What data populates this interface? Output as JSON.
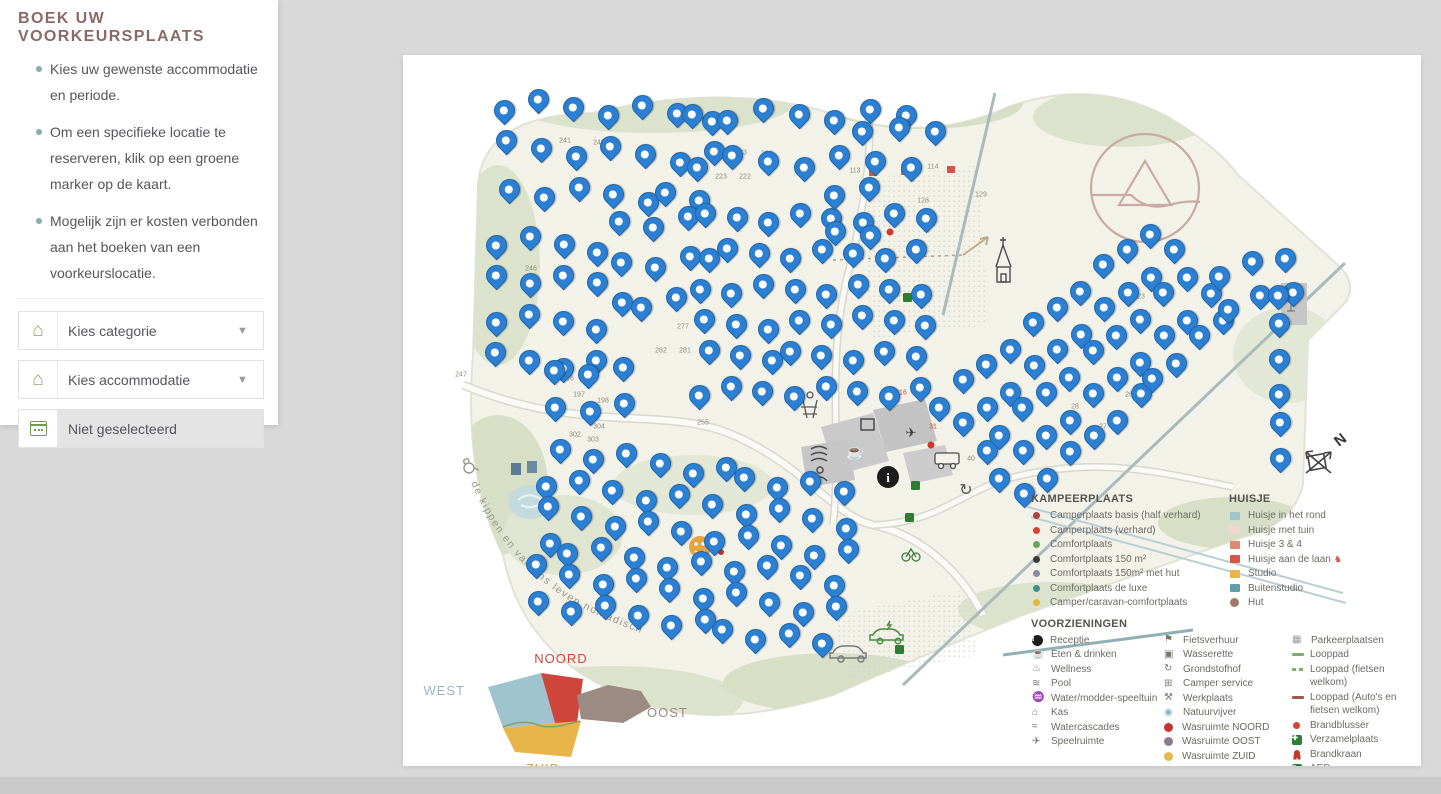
{
  "page": {
    "background": "#d9d9d9"
  },
  "sidebar": {
    "title": "BOEK UW VOORKEURSPLAATS",
    "instructions": [
      "Kies uw gewenste accommodatie en periode.",
      "Om een specifieke locatie te reserveren, klik op een groene marker op de kaart.",
      "Mogelijk zijn er kosten verbonden aan het boeken van een voorkeurslocatie."
    ],
    "category_dropdown": {
      "label": "Kies categorie"
    },
    "accommodation_dropdown": {
      "label": "Kies accommodatie"
    },
    "date_field": {
      "label": "Niet geselecteerd"
    }
  },
  "map": {
    "pin_color": "#2c80d3",
    "pin_border": "#1f65a8",
    "curved_text": "de kippen en varkens leven nomadisch",
    "compass_label": "N",
    "region_overview": {
      "north": "NOORD",
      "west": "WEST",
      "east": "OOST",
      "south": "ZUID",
      "north_color": "#d0453a",
      "west_color": "#9fc3cf",
      "east_color": "#9c8b82",
      "south_color": "#e8b54a",
      "north_label_color": "#d0453a",
      "west_label_color": "#9db4bd",
      "east_label_color": "#9c8b82",
      "south_label_color": "#e2992f"
    },
    "pin_clusters": [
      {
        "x": 105,
        "y": 62,
        "cols": 7,
        "rows": 3,
        "dx": 34,
        "dy": 42,
        "rot": 3,
        "jit": 9
      },
      {
        "x": 100,
        "y": 196,
        "cols": 4,
        "rows": 4,
        "dx": 33,
        "dy": 41,
        "rot": 4,
        "jit": 8
      },
      {
        "x": 212,
        "y": 182,
        "cols": 3,
        "rows": 3,
        "dx": 34,
        "dy": 40,
        "rot": 0,
        "jit": 8
      },
      {
        "x": 296,
        "y": 74,
        "cols": 7,
        "rows": 2,
        "dx": 35,
        "dy": 46,
        "rot": 0,
        "jit": 9
      },
      {
        "x": 300,
        "y": 176,
        "cols": 8,
        "rows": 6,
        "dx": 31,
        "dy": 35,
        "rot": 0,
        "jit": 7
      },
      {
        "x": 150,
        "y": 330,
        "cols": 3,
        "rows": 2,
        "dx": 34,
        "dy": 36,
        "rot": 0,
        "jit": 6
      },
      {
        "x": 152,
        "y": 408,
        "cols": 10,
        "rows": 6,
        "dx": 33,
        "dy": 31,
        "rot": 8,
        "jit": 8
      },
      {
        "x": 540,
        "y": 362,
        "cols": 10,
        "rows": 5,
        "dx": 30,
        "dy": 30,
        "rot": -40,
        "jit": 6
      },
      {
        "x": 820,
        "y": 232,
        "cols": 3,
        "rows": 2,
        "dx": 33,
        "dy": 34,
        "rot": -12,
        "jit": 6
      },
      {
        "x": 876,
        "y": 252,
        "cols": 1,
        "rows": 6,
        "dx": 0,
        "dy": 33,
        "rot": 0,
        "jit": 4
      },
      {
        "x": 458,
        "y": 88,
        "cols": 3,
        "rows": 1,
        "dx": 36,
        "dy": 0,
        "rot": 2,
        "jit": 4
      },
      {
        "x": 428,
        "y": 150,
        "cols": 2,
        "rows": 2,
        "dx": 34,
        "dy": 40,
        "rot": 0,
        "jit": 6
      }
    ],
    "plot_numbers": [
      {
        "n": "241",
        "x": 162,
        "y": 86
      },
      {
        "n": "240",
        "x": 196,
        "y": 88
      },
      {
        "n": "233",
        "x": 338,
        "y": 98
      },
      {
        "n": "236",
        "x": 364,
        "y": 99
      },
      {
        "n": "223",
        "x": 318,
        "y": 122
      },
      {
        "n": "222",
        "x": 342,
        "y": 122
      },
      {
        "n": "246",
        "x": 128,
        "y": 214
      },
      {
        "n": "247",
        "x": 58,
        "y": 320
      },
      {
        "n": "277",
        "x": 280,
        "y": 272
      },
      {
        "n": "282",
        "x": 258,
        "y": 296
      },
      {
        "n": "281",
        "x": 282,
        "y": 296
      },
      {
        "n": "196",
        "x": 165,
        "y": 324
      },
      {
        "n": "197",
        "x": 176,
        "y": 340
      },
      {
        "n": "198",
        "x": 200,
        "y": 346
      },
      {
        "n": "199",
        "x": 226,
        "y": 350
      },
      {
        "n": "255",
        "x": 300,
        "y": 368
      },
      {
        "n": "302",
        "x": 172,
        "y": 380
      },
      {
        "n": "304",
        "x": 196,
        "y": 372
      },
      {
        "n": "303",
        "x": 190,
        "y": 385
      },
      {
        "n": "113",
        "x": 452,
        "y": 116
      },
      {
        "n": "114",
        "x": 530,
        "y": 112
      },
      {
        "n": "128",
        "x": 520,
        "y": 146
      },
      {
        "n": "129",
        "x": 578,
        "y": 140
      },
      {
        "n": "216",
        "x": 498,
        "y": 338,
        "c": "#d0453a"
      },
      {
        "n": "31",
        "x": 530,
        "y": 372,
        "c": "#d0453a"
      },
      {
        "n": "32",
        "x": 622,
        "y": 356
      },
      {
        "n": "27",
        "x": 700,
        "y": 372
      },
      {
        "n": "28",
        "x": 672,
        "y": 352
      },
      {
        "n": "26",
        "x": 726,
        "y": 340
      },
      {
        "n": "23",
        "x": 738,
        "y": 242
      },
      {
        "n": "22",
        "x": 752,
        "y": 222
      },
      {
        "n": "40",
        "x": 568,
        "y": 404
      }
    ],
    "legend": {
      "kampeerplaats": {
        "title": "KAMPEERPLAATS",
        "items": [
          {
            "label": "Camperplaats basis (half verhard)",
            "marker": "dot",
            "color": "#a8473a",
            "icon": "camperplaats-basis-dot"
          },
          {
            "label": "Camperplaats (verhard)",
            "marker": "dot",
            "color": "#d8422e",
            "icon": "camperplaats-verhard-dot"
          },
          {
            "label": "Comfortplaats",
            "marker": "dot",
            "color": "#6aa559",
            "icon": "comfortplaats-dot"
          },
          {
            "label": "Comfortplaats 150 m²",
            "marker": "dot",
            "color": "#3a3a3a",
            "icon": "comfortplaats-150-dot"
          },
          {
            "label": "Comfortplaats 150m² met hut",
            "marker": "dot",
            "color": "#8a8aa0",
            "icon": "comfortplaats-150-hut-dot"
          },
          {
            "label": "Comfortplaats de luxe",
            "marker": "dot",
            "color": "#3f8f8f",
            "icon": "comfortplaats-deluxe-dot"
          },
          {
            "label": "Camper/caravan-comfortplaats",
            "marker": "dot",
            "color": "#e0b83e",
            "icon": "camper-caravan-dot"
          }
        ]
      },
      "huisje": {
        "title": "HUISJE",
        "items": [
          {
            "label": "Huisje in het rond",
            "marker": "square",
            "color": "#9fc3cf",
            "icon": "huisje-rond-square"
          },
          {
            "label": "Huisje met tuin",
            "marker": "square",
            "color": "#f2d7cd",
            "icon": "huisje-tuin-square"
          },
          {
            "label": "Huisje 3 & 4",
            "marker": "square",
            "color": "#dd8a70",
            "icon": "huisje-3-4-square"
          },
          {
            "label": "Huisje aan de laan",
            "marker": "square",
            "color": "#d85446",
            "icon": "huisje-laan-square",
            "suffix": "♞",
            "suffix_color": "#d85446"
          },
          {
            "label": "Studio",
            "marker": "square",
            "color": "#e8b54a",
            "icon": "studio-square"
          },
          {
            "label": "Buitenstudio",
            "marker": "square",
            "color": "#5f9ea8",
            "icon": "buitenstudio-square"
          },
          {
            "label": "Hut",
            "marker": "bigdot",
            "color": "#9c7a64",
            "icon": "hut-dot"
          }
        ]
      },
      "voorzieningen": {
        "title": "VOORZIENINGEN",
        "col1": [
          {
            "label": "Receptie",
            "marker": "info",
            "icon": "receptie-info-icon"
          },
          {
            "label": "Eten & drinken",
            "marker": "glyph",
            "glyph": "☕",
            "icon": "eten-drinken-icon"
          },
          {
            "label": "Wellness",
            "marker": "glyph",
            "glyph": "♨",
            "icon": "wellness-icon"
          },
          {
            "label": "Pool",
            "marker": "glyph",
            "glyph": "≋",
            "icon": "pool-icon"
          },
          {
            "label": "Water/modder-speeltuin",
            "marker": "glyph",
            "glyph": "♒",
            "icon": "water-modder-speeltuin-icon"
          },
          {
            "label": "Kas",
            "marker": "glyph",
            "glyph": "⌂",
            "icon": "kas-icon"
          },
          {
            "label": "Watercascades",
            "marker": "glyph",
            "glyph": "≈",
            "icon": "watercascades-icon"
          },
          {
            "label": "Speelruimte",
            "marker": "glyph",
            "glyph": "✈",
            "icon": "speelruimte-icon"
          }
        ],
        "col2": [
          {
            "label": "Fietsverhuur",
            "marker": "glyph",
            "glyph": "⚑",
            "icon": "fietsverhuur-icon"
          },
          {
            "label": "Wasserette",
            "marker": "glyph",
            "glyph": "▣",
            "icon": "wasserette-icon"
          },
          {
            "label": "Grondstofhof",
            "marker": "glyph",
            "glyph": "↻",
            "icon": "grondstofhof-icon"
          },
          {
            "label": "Camper service",
            "marker": "glyph",
            "glyph": "⊞",
            "icon": "camper-service-icon"
          },
          {
            "label": "Werkplaats",
            "marker": "glyph",
            "glyph": "⚒",
            "icon": "werkplaats-icon"
          },
          {
            "label": "Natuurvijver",
            "marker": "glyph",
            "glyph": "◉",
            "color": "#7fb6c9",
            "icon": "natuurvijver-icon"
          },
          {
            "label": "Wasruimte NOORD",
            "marker": "bigdot",
            "color": "#c2362e",
            "icon": "wasruimte-noord-dot"
          },
          {
            "label": "Wasruimte OOST",
            "marker": "bigdot",
            "color": "#8f7b90",
            "icon": "wasruimte-oost-dot"
          },
          {
            "label": "Wasruimte ZUID",
            "marker": "bigdot",
            "color": "#e3b94d",
            "icon": "wasruimte-zuid-dot"
          }
        ],
        "col3": [
          {
            "label": "Parkeerplaatsen",
            "marker": "glyph",
            "glyph": "▦",
            "color": "#9a9a94",
            "icon": "parkeerplaatsen-icon"
          },
          {
            "label": "Looppad",
            "marker": "line",
            "color": "#7fae6a",
            "icon": "looppad-line"
          },
          {
            "label": "Looppad (fietsen welkom)",
            "marker": "dashes",
            "color": "#7fae6a",
            "icon": "looppad-fietsen-line"
          },
          {
            "label": "Looppad (Auto's en fietsen welkom)",
            "marker": "line",
            "color": "#9c5a4a",
            "icon": "looppad-autos-line"
          },
          {
            "label": "Brandblusser",
            "marker": "dot",
            "color": "#d8422e",
            "icon": "brandblusser-dot"
          },
          {
            "label": "Verzamelplaats",
            "marker": "box",
            "color": "#2e7d32",
            "glyph": "✚",
            "icon": "verzamelplaats-icon"
          },
          {
            "label": "Brandkraan",
            "marker": "hydrant",
            "icon": "brandkraan-icon"
          },
          {
            "label": "AED",
            "marker": "box",
            "color": "#2e7d32",
            "glyph": "♥",
            "icon": "aed-icon"
          }
        ]
      }
    }
  }
}
